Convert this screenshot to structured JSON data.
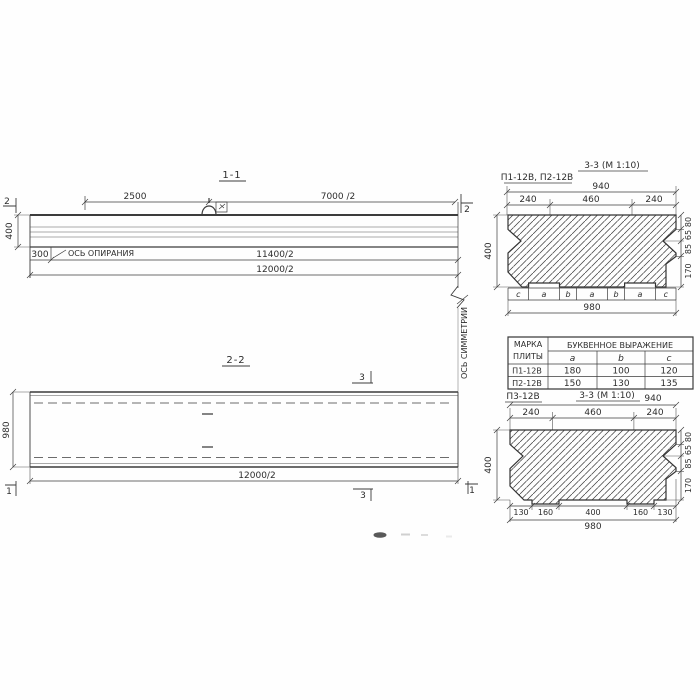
{
  "s11": {
    "title": "1-1",
    "dim_a": "2500",
    "dim_b": "7000 /2",
    "marker_left": "2",
    "marker_right": "2",
    "height": "400",
    "offset": "300",
    "support_label": "ОСЬ ОПИРАНИЯ",
    "dim_c": "11400/2",
    "dim_d": "12000/2"
  },
  "sym": {
    "label": "ОСЬ СИММЕТРИИ"
  },
  "s22": {
    "title": "2-2",
    "width": "980",
    "length": "12000/2",
    "marker_top": "3",
    "marker_bottom": "3",
    "marker_left": "1",
    "marker_right": "1"
  },
  "s33a": {
    "title": "3-3 (М 1:10)",
    "marks": "П1-12В, П2-12В",
    "total_top": "940",
    "parts_top": [
      "240",
      "460",
      "240"
    ],
    "height": "400",
    "right": [
      "80",
      "65",
      "85",
      "170"
    ],
    "letters": [
      "c",
      "a",
      "b",
      "a",
      "b",
      "a",
      "c"
    ],
    "total_bottom": "980"
  },
  "table": {
    "head_col_l1": "МАРКА",
    "head_col_l2": "ПЛИТЫ",
    "head_group": "БУКВЕННОЕ  ВЫРАЖЕНИЕ",
    "cols": [
      "a",
      "b",
      "c"
    ],
    "rows": [
      {
        "mark": "П1-12В",
        "a": "180",
        "b": "100",
        "c": "120"
      },
      {
        "mark": "П2-12В",
        "a": "150",
        "b": "130",
        "c": "135"
      }
    ]
  },
  "s33b": {
    "mark": "П3-12В",
    "title": "3-3 (М 1:10)",
    "total_top": "940",
    "parts_top": [
      "240",
      "460",
      "240"
    ],
    "height": "400",
    "right": [
      "80",
      "65",
      "85",
      "170"
    ],
    "bottom": [
      "130",
      "160",
      "400",
      "160",
      "130"
    ],
    "total_bottom": "980"
  }
}
